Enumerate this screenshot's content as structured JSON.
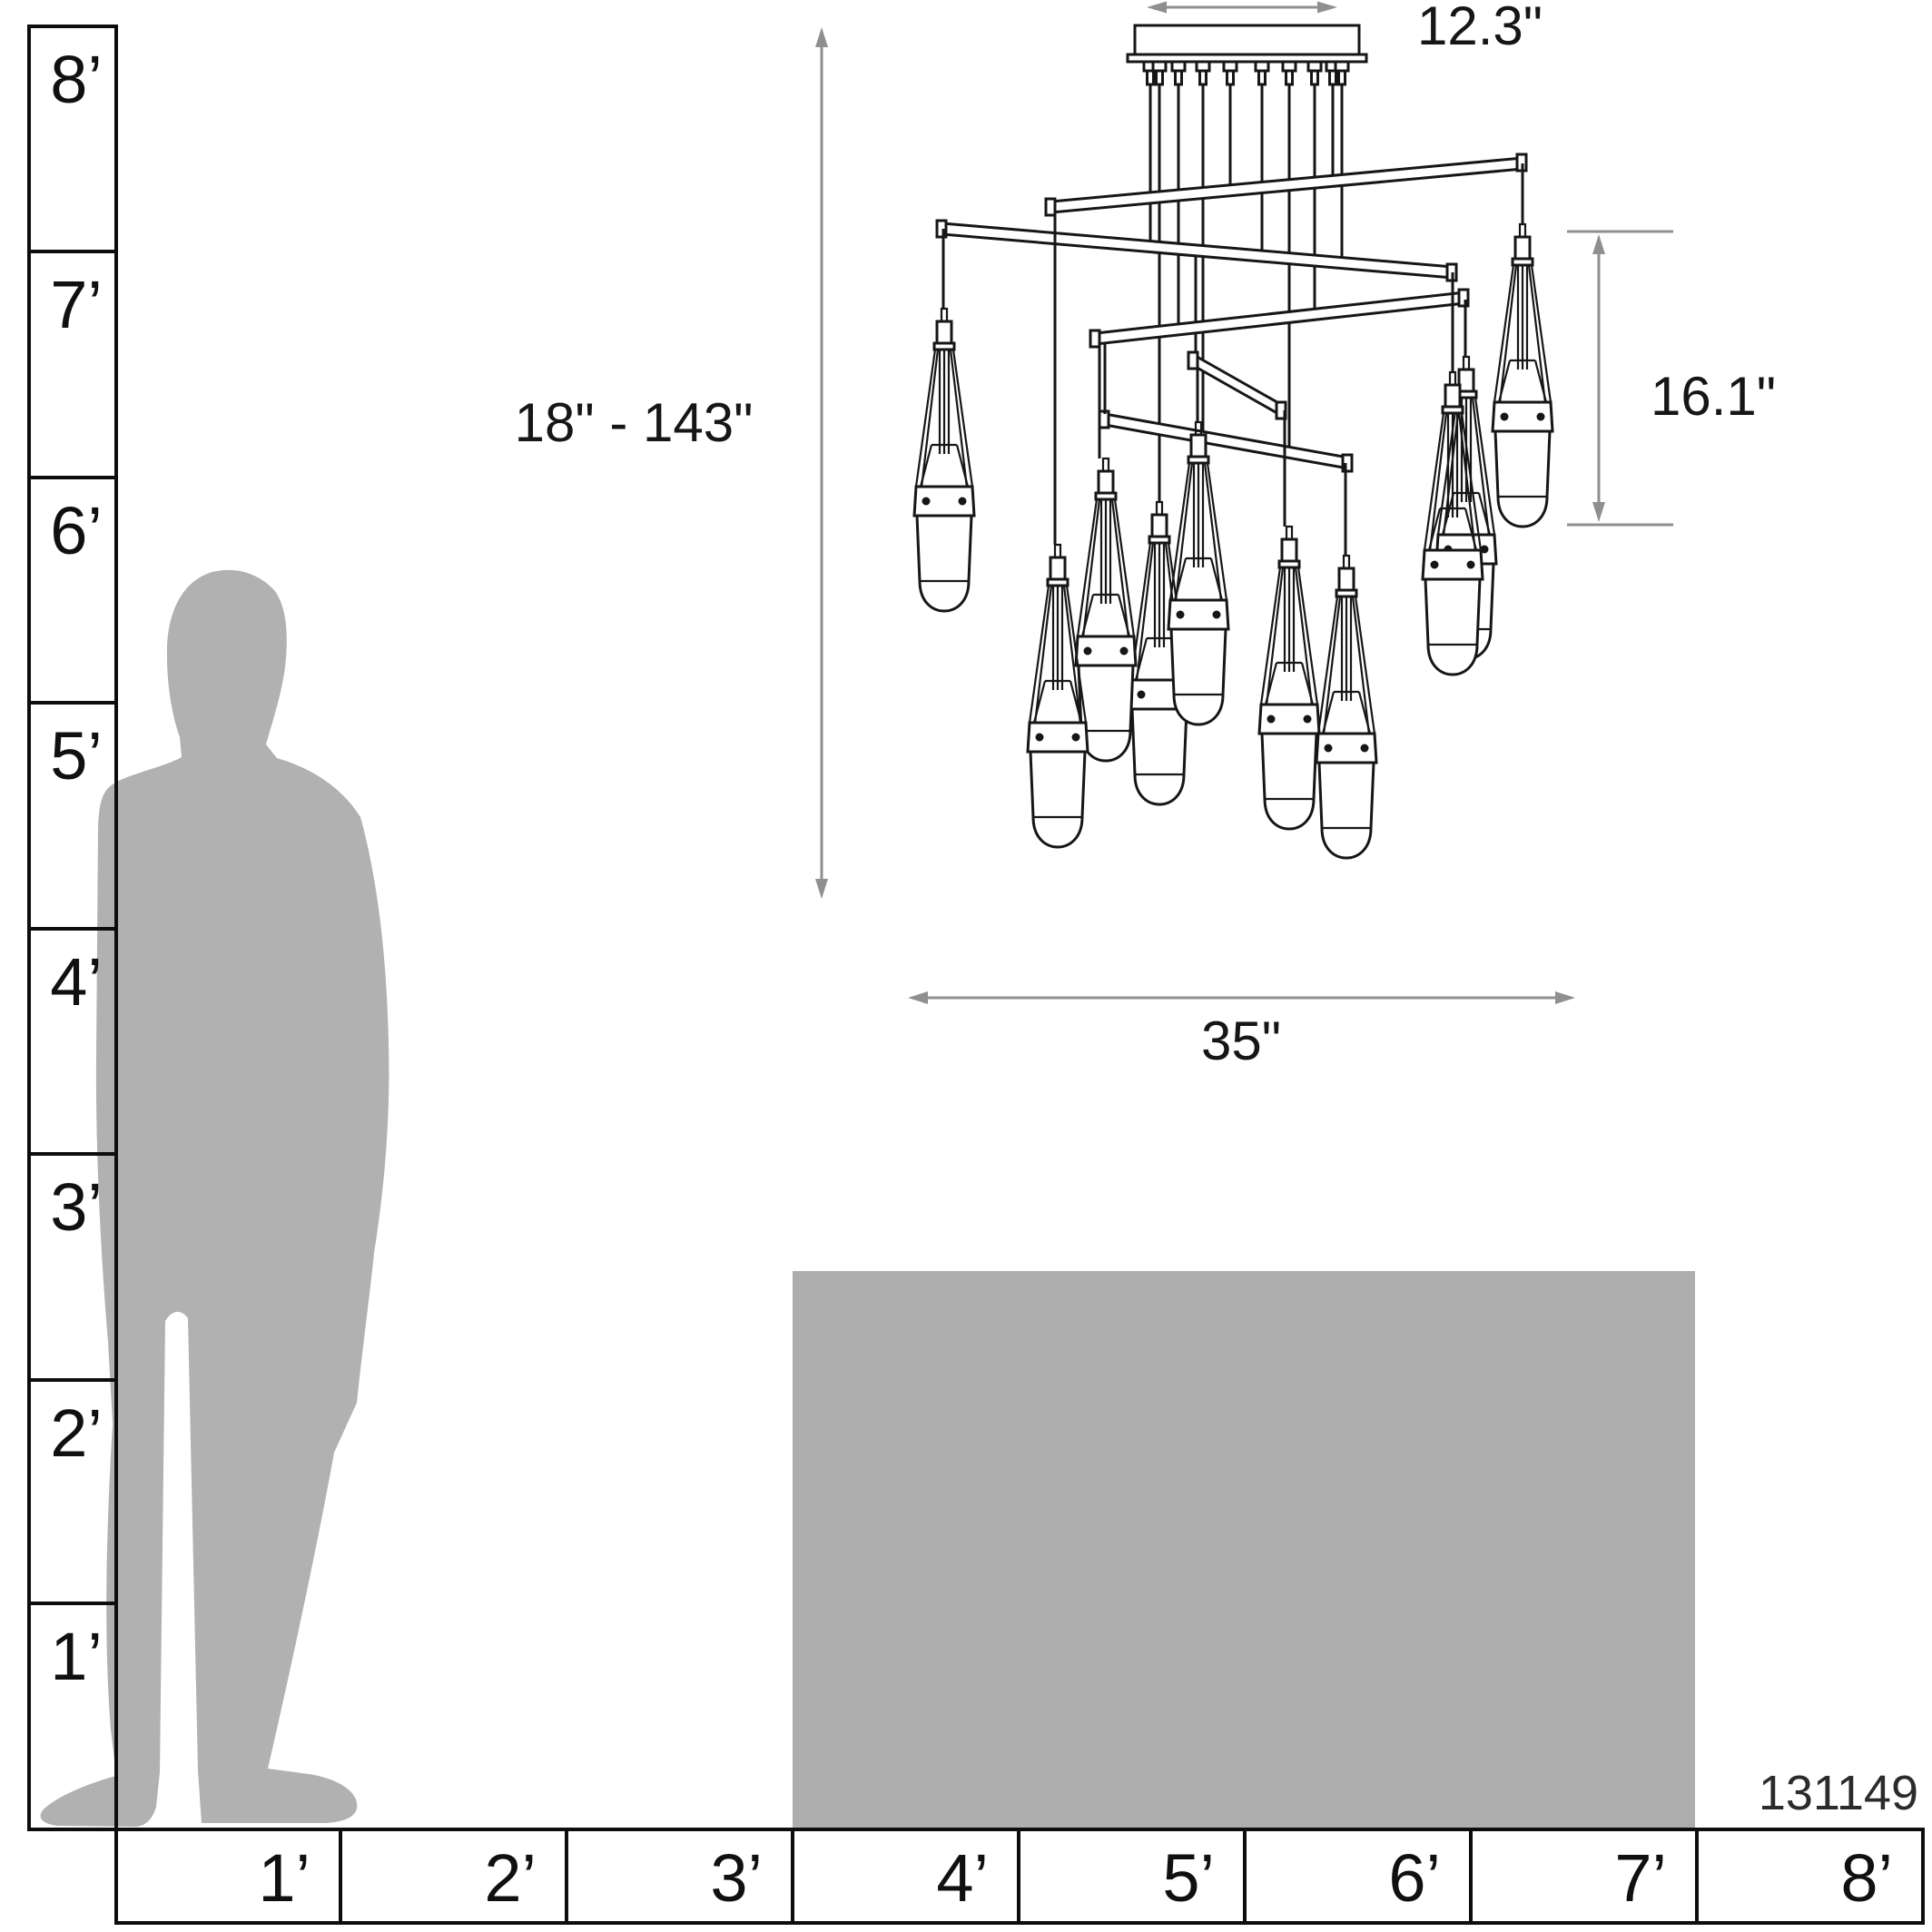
{
  "product": {
    "number": "131149"
  },
  "dimensions": {
    "canopy_width": "12.3\"",
    "height_range": "18\" - 143\"",
    "pendant_height": "16.1\"",
    "fixture_width": "35\""
  },
  "vertical_ruler": {
    "labels": [
      "8’",
      "7’",
      "6’",
      "5’",
      "4’",
      "3’",
      "2’",
      "1’"
    ]
  },
  "horizontal_ruler": {
    "labels": [
      "1’",
      "2’",
      "3’",
      "4’",
      "5’",
      "6’",
      "7’",
      "8’"
    ]
  },
  "colors": {
    "silhouette": "#b1b1b1",
    "reference_box": "#adadad",
    "dimension_line": "#8f8f8f",
    "line_art": "#161616"
  }
}
